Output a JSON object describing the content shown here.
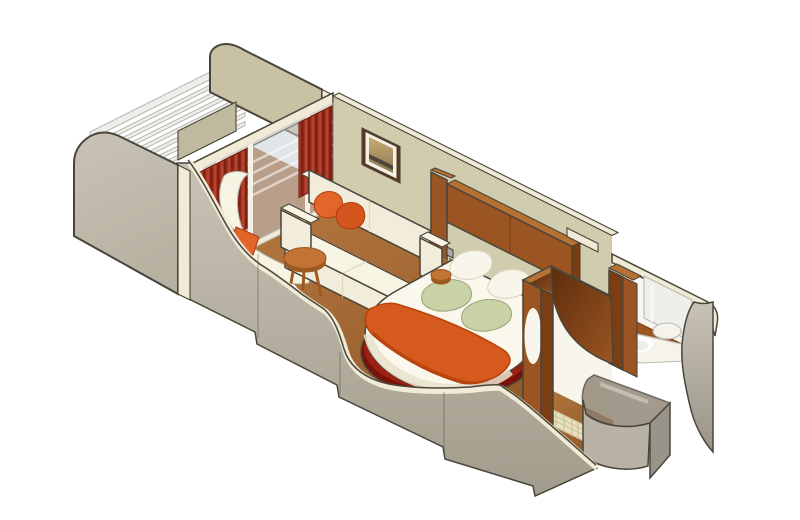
{
  "illustration": {
    "kind": "isometric-cutaway-rendering",
    "subject": "cruise ship balcony stateroom floor plan",
    "areas": [
      {
        "name": "balcony",
        "items": [
          "privacy-partition-aft",
          "privacy-partition-forward",
          "railing",
          "sliding-glass-doors",
          "curtains",
          "deck-cushion"
        ]
      },
      {
        "name": "living-area",
        "items": [
          "sofa",
          "orange-throw-pillows",
          "round-coffee-table",
          "curved-lounge-chair",
          "framed-artwork"
        ]
      },
      {
        "name": "sleeping-area",
        "items": [
          "round-platform-bed",
          "bed-runner",
          "green-pillows",
          "white-pillows",
          "overhead-cabinets",
          "reading-sconce",
          "nightstand"
        ]
      },
      {
        "name": "wardrobe",
        "items": [
          "open-top-wardrobe",
          "curved-divider-panel",
          "oval-cutout"
        ]
      },
      {
        "name": "bathroom",
        "items": [
          "vanity-counter",
          "round-basin",
          "mirror",
          "wood-paneling",
          "curved-shower-enclosure",
          "tiled-entry-floor"
        ]
      }
    ]
  },
  "palette": {
    "outline": "#4A453B",
    "cream": "#F0EAD6",
    "khaki_wall": "#D2CCAE",
    "khaki_partition": "#C8C1A4",
    "khaki_deck": "#BFB9A0",
    "gray_hi": "#C8C3B4",
    "gray_mid": "#B7B1A2",
    "gray_lo": "#A29C8D",
    "glass": "#C9CFD2",
    "curtain": "#A43523",
    "curtain_dark": "#7C2114",
    "curtain_light": "#BE4A2E",
    "floor_light": "#B5773F",
    "floor_dark": "#8A5526",
    "balcony_floor": "#A86C39",
    "sofa": "#F2EDDA",
    "sofa_top": "#F8F4E4",
    "sofa_shadow": "#DCD5BC",
    "pillow_orange": "#E2662A",
    "pillow_orange2": "#D4551E",
    "pillow_orange_dark": "#B23F10",
    "table_wood": "#C17434",
    "table_wood_dark": "#9C5A20",
    "wood_light": "#B57234",
    "wood_mid": "#9A5523",
    "wood_dark": "#7B3D12",
    "wood_deep": "#5E2D0C",
    "wood_inner": "#8A4A1E",
    "bed_white": "#FAF7ED",
    "bed_side": "#E8E2CC",
    "runner": "#D65A1E",
    "runner_dark": "#B8430F",
    "base_maroon": "#9C2113",
    "base_maroon_dark": "#77130A",
    "pillow_green": "#C9D1A7",
    "pillow_green_dark": "#9FAA7D",
    "pillow_white": "#F8F5EA",
    "tile": "#E9E0BF",
    "tile_line": "#CBC19C",
    "mirror": "#ECEFEA",
    "white_wall": "#F8F6EC",
    "vanity": "#F6F3EA",
    "shower_glass": "#8D8271",
    "shower_face": "#B7B2A5",
    "shower_side": "#99948A",
    "rail": "#EFEEE8",
    "rail_shadow": "#B9BBB5",
    "art_sky": "#C9A96E",
    "art_mid": "#8A7A58",
    "art_dark": "#4F4636",
    "frame": "#563823",
    "mat": "#F4F1E6",
    "sconce": "#ABAAA6",
    "white": "#FFFFFF"
  }
}
